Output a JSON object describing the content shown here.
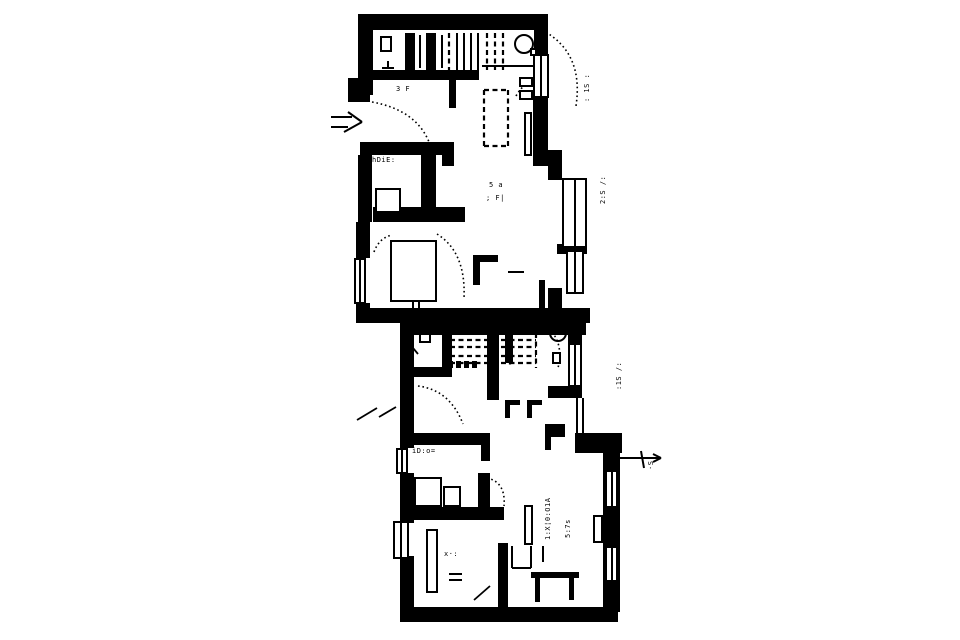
{
  "page": {
    "background": "#ffffff",
    "ink": "#000000",
    "description": "scanned monochrome floor plan of two dwelling units"
  },
  "plan": {
    "canvas": {
      "width": 960,
      "height": 640
    },
    "walls": [
      [
        358,
        14,
        190,
        16
      ],
      [
        534,
        14,
        14,
        44
      ],
      [
        533,
        92,
        15,
        66
      ],
      [
        533,
        150,
        29,
        16
      ],
      [
        548,
        164,
        14,
        16
      ],
      [
        557,
        244,
        30,
        10
      ],
      [
        548,
        288,
        14,
        22
      ],
      [
        358,
        14,
        15,
        81
      ],
      [
        348,
        78,
        22,
        24
      ],
      [
        360,
        142,
        94,
        13
      ],
      [
        360,
        142,
        12,
        24
      ],
      [
        442,
        142,
        12,
        24
      ],
      [
        358,
        155,
        14,
        67
      ],
      [
        421,
        150,
        15,
        60
      ],
      [
        373,
        207,
        92,
        15
      ],
      [
        356,
        222,
        14,
        36
      ],
      [
        356,
        303,
        14,
        8
      ],
      [
        356,
        308,
        234,
        15
      ],
      [
        539,
        280,
        6,
        30
      ],
      [
        405,
        33,
        10,
        40
      ],
      [
        426,
        33,
        10,
        40
      ],
      [
        449,
        70,
        7,
        38
      ],
      [
        371,
        70,
        108,
        10
      ],
      [
        473,
        255,
        25,
        7
      ],
      [
        473,
        255,
        7,
        30
      ],
      [
        400,
        321,
        186,
        14
      ],
      [
        400,
        321,
        14,
        112
      ],
      [
        400,
        433,
        14,
        15
      ],
      [
        400,
        473,
        14,
        50
      ],
      [
        400,
        556,
        14,
        66
      ],
      [
        404,
        607,
        214,
        15
      ],
      [
        568,
        330,
        14,
        13
      ],
      [
        568,
        387,
        14,
        11
      ],
      [
        548,
        386,
        34,
        12
      ],
      [
        575,
        433,
        47,
        20
      ],
      [
        603,
        450,
        17,
        162
      ],
      [
        545,
        424,
        20,
        13
      ],
      [
        545,
        424,
        6,
        26
      ],
      [
        442,
        321,
        10,
        50
      ],
      [
        400,
        367,
        52,
        10
      ],
      [
        487,
        314,
        12,
        86
      ],
      [
        505,
        323,
        8,
        40
      ],
      [
        400,
        433,
        90,
        12
      ],
      [
        481,
        433,
        9,
        28
      ],
      [
        478,
        473,
        12,
        36
      ],
      [
        412,
        507,
        92,
        13
      ],
      [
        498,
        543,
        10,
        64
      ],
      [
        505,
        400,
        15,
        5
      ],
      [
        505,
        400,
        5,
        18
      ],
      [
        527,
        400,
        15,
        5
      ],
      [
        527,
        400,
        5,
        18
      ],
      [
        448,
        361,
        5,
        7
      ],
      [
        456,
        361,
        5,
        7
      ],
      [
        464,
        361,
        5,
        7
      ],
      [
        472,
        361,
        5,
        7
      ],
      [
        531,
        572,
        48,
        6
      ],
      [
        535,
        578,
        5,
        24
      ],
      [
        569,
        578,
        5,
        22
      ]
    ],
    "windows": [
      [
        533,
        54,
        16,
        44
      ],
      [
        562,
        178,
        25,
        70
      ],
      [
        566,
        250,
        18,
        44
      ],
      [
        354,
        258,
        12,
        46
      ],
      [
        568,
        343,
        14,
        44
      ],
      [
        396,
        448,
        12,
        26
      ],
      [
        393,
        521,
        16,
        38
      ],
      [
        605,
        470,
        13,
        38
      ],
      [
        605,
        546,
        13,
        36
      ]
    ],
    "fixtures": [
      [
        380,
        36,
        12,
        16
      ],
      [
        375,
        188,
        26,
        25
      ],
      [
        390,
        240,
        47,
        62
      ],
      [
        524,
        112,
        8,
        44
      ],
      [
        519,
        77,
        14,
        10
      ],
      [
        519,
        90,
        14,
        10
      ],
      [
        414,
        477,
        28,
        30
      ],
      [
        443,
        486,
        18,
        21
      ],
      [
        593,
        515,
        10,
        28
      ],
      [
        524,
        505,
        9,
        40
      ],
      [
        426,
        529,
        12,
        64
      ],
      [
        419,
        333,
        12,
        10
      ],
      [
        530,
        48,
        7,
        8
      ],
      [
        552,
        352,
        9,
        12
      ]
    ],
    "thin_lines": [
      [
        420,
        35,
        420,
        68
      ],
      [
        442,
        35,
        442,
        68
      ],
      [
        457,
        33,
        457,
        70
      ],
      [
        464,
        33,
        464,
        70
      ],
      [
        471,
        33,
        471,
        70
      ],
      [
        478,
        33,
        478,
        70
      ],
      [
        482,
        66,
        533,
        66
      ],
      [
        382,
        68,
        394,
        68
      ],
      [
        388,
        61,
        388,
        68
      ],
      [
        508,
        272,
        524,
        272
      ],
      [
        405,
        242,
        405,
        300
      ],
      [
        420,
        242,
        420,
        300
      ],
      [
        512,
        546,
        512,
        568
      ],
      [
        512,
        568,
        531,
        568
      ],
      [
        531,
        546,
        531,
        568
      ],
      [
        543,
        546,
        543,
        562
      ],
      [
        449,
        574,
        462,
        574
      ],
      [
        449,
        580,
        462,
        580
      ],
      [
        413,
        296,
        413,
        310
      ],
      [
        419,
        296,
        419,
        310
      ],
      [
        577,
        398,
        577,
        433
      ],
      [
        583,
        398,
        583,
        433
      ],
      [
        331,
        117,
        352,
        117
      ],
      [
        331,
        127,
        348,
        127
      ],
      [
        348,
        112,
        362,
        122
      ],
      [
        344,
        132,
        362,
        122
      ],
      [
        603,
        458,
        660,
        458
      ],
      [
        641,
        451,
        644,
        468
      ],
      [
        653,
        454,
        661,
        458
      ],
      [
        653,
        462,
        661,
        458
      ]
    ],
    "dashed_lines": [
      [
        449,
        33,
        449,
        70
      ],
      [
        487,
        33,
        487,
        70
      ],
      [
        495,
        33,
        495,
        70
      ],
      [
        503,
        33,
        503,
        70
      ],
      [
        484,
        90,
        508,
        90
      ],
      [
        484,
        146,
        508,
        146
      ],
      [
        484,
        90,
        484,
        146
      ],
      [
        508,
        90,
        508,
        146
      ],
      [
        450,
        340,
        536,
        340
      ],
      [
        450,
        347,
        536,
        347
      ],
      [
        450,
        356,
        536,
        356
      ],
      [
        450,
        363,
        536,
        363
      ],
      [
        510,
        334,
        510,
        366
      ],
      [
        536,
        333,
        536,
        368
      ]
    ],
    "door_arcs": [
      "M 542 30 Q 584 52 576 106",
      "M 372 102 Q 416 110 429 142",
      "M 437 234 Q 466 252 464 298",
      "M 374 252 Q 379 238 392 235",
      "M 418 386 Q 450 390 463 424",
      "M 487 478 Q 506 482 504 506",
      "M 549 329 Q 564 343 558 368",
      "M 516 96 Q 524 82 536 80"
    ],
    "ticks": [
      [
        357,
        420,
        377,
        408
      ],
      [
        379,
        417,
        396,
        407
      ],
      [
        474,
        600,
        490,
        586
      ],
      [
        408,
        342,
        418,
        354
      ]
    ],
    "circles": [
      [
        524,
        44,
        9
      ],
      [
        558,
        333,
        8
      ]
    ],
    "annotations": [
      {
        "text": "3 F",
        "x": 396,
        "y": 86,
        "rot": 0
      },
      {
        "text": "hDiE:",
        "x": 372,
        "y": 157,
        "rot": 0
      },
      {
        "text": "5 a",
        "x": 489,
        "y": 182,
        "rot": 0
      },
      {
        "text": "; F|",
        "x": 486,
        "y": 195,
        "rot": 0
      },
      {
        "text": "iD:o=",
        "x": 412,
        "y": 448,
        "rot": 0
      },
      {
        "text": "x·:",
        "x": 444,
        "y": 551,
        "rot": 0
      },
      {
        "text": "1:X¦0:O1A",
        "x": 545,
        "y": 540,
        "rot": -90
      },
      {
        "text": "5:7s",
        "x": 565,
        "y": 538,
        "rot": -90
      },
      {
        "text": ": 1S :",
        "x": 584,
        "y": 102,
        "rot": -90
      },
      {
        "text": "2:S /:",
        "x": 600,
        "y": 204,
        "rot": -90
      },
      {
        "text": ":1S /:",
        "x": 616,
        "y": 390,
        "rot": -90
      },
      {
        "text": "·S:",
        "x": 648,
        "y": 470,
        "rot": -90
      }
    ]
  }
}
